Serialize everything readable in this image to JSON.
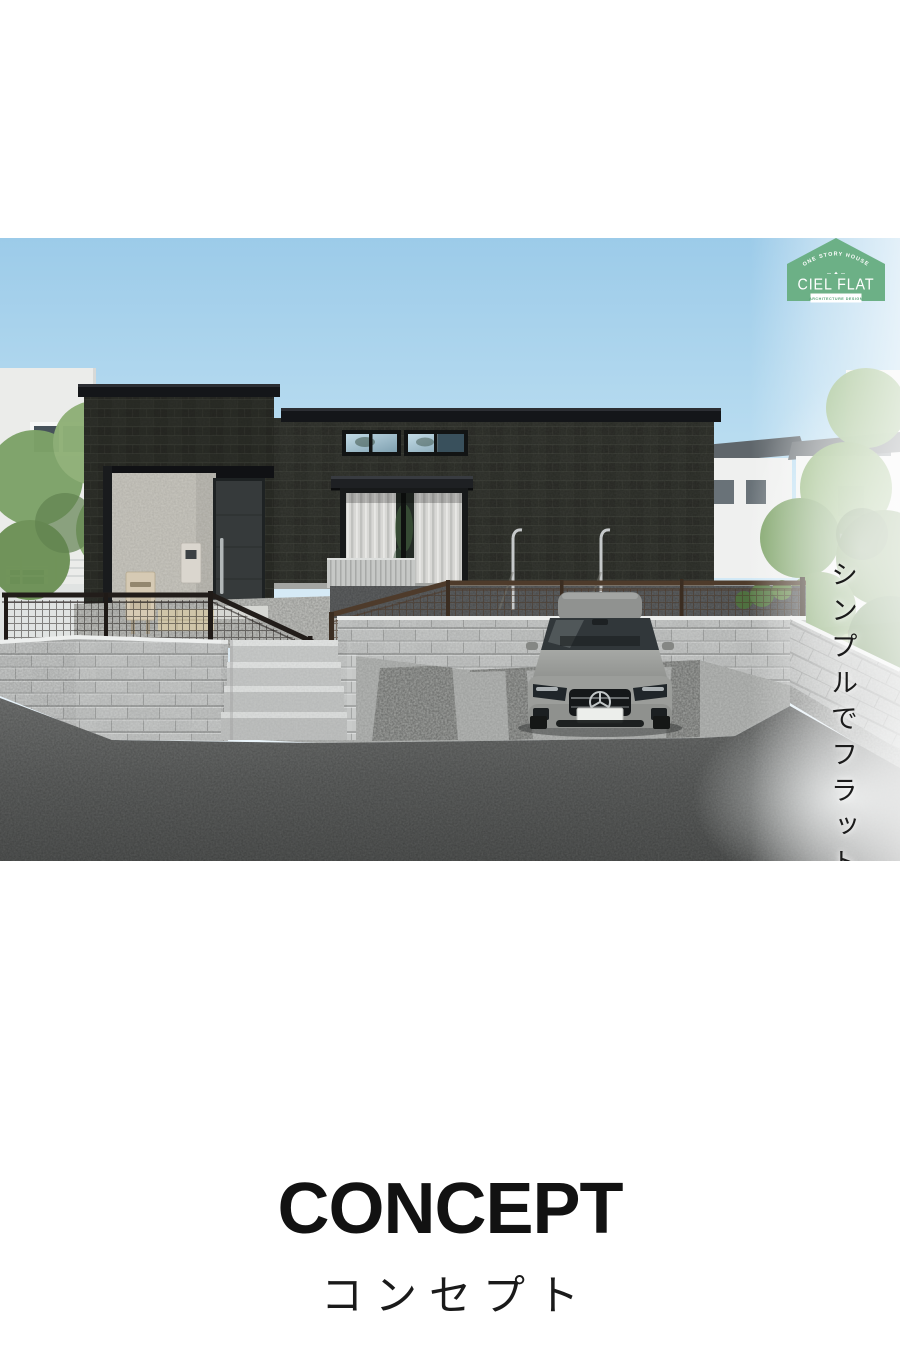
{
  "brand_badge": {
    "arc_text": "ONE STORY HOUSE",
    "name": "CIEL FLAT",
    "banner_text": "ARCHITECTURE DESIGN",
    "badge_green": "#6cb086",
    "banner_text_color": "#56a377"
  },
  "photo_overlay": {
    "tagline": "シンプルでフラットに暮らす家",
    "location_inline": "in",
    "location_name": "清武加納"
  },
  "section": {
    "title": "CONCEPT",
    "subtitle": "コンセプト"
  },
  "palette": {
    "sky_top": "#9ccbe9",
    "house_brick": "#2b2d27",
    "block_wall": "#c9cbca",
    "asphalt": "#5a5c5b",
    "heading_text": "#121212"
  }
}
